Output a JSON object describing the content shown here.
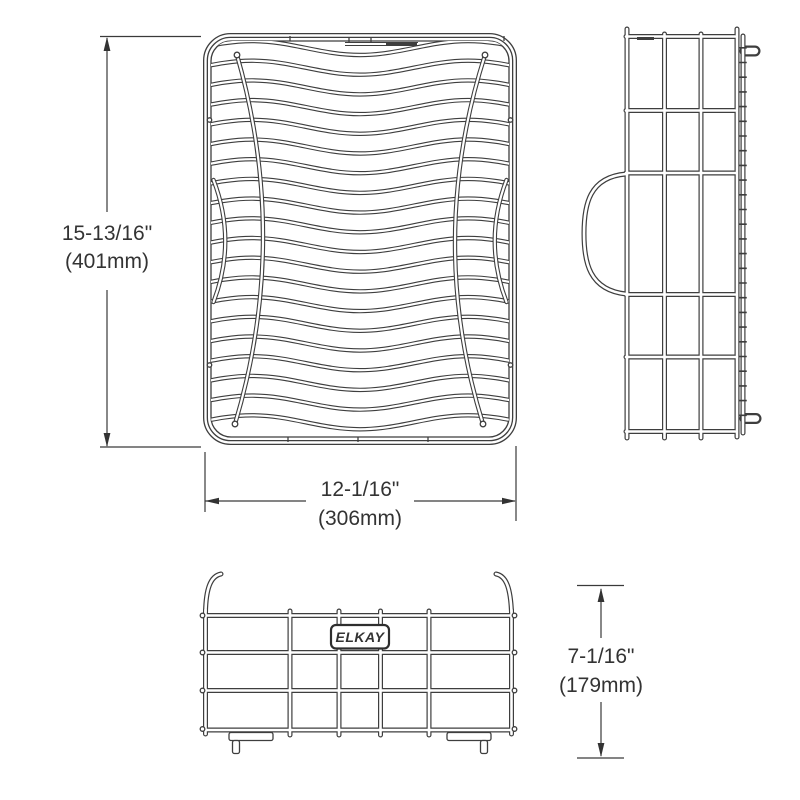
{
  "dimensions": {
    "height": {
      "inches": "15-13/16\"",
      "mm": "(401mm)"
    },
    "width": {
      "inches": "12-1/16\"",
      "mm": "(306mm)"
    },
    "depth": {
      "inches": "7-1/16\"",
      "mm": "(179mm)"
    }
  },
  "brand": {
    "label": "ELKAY"
  },
  "colors": {
    "line": "#3e3e3e",
    "text": "#333333",
    "background": "#ffffff"
  }
}
